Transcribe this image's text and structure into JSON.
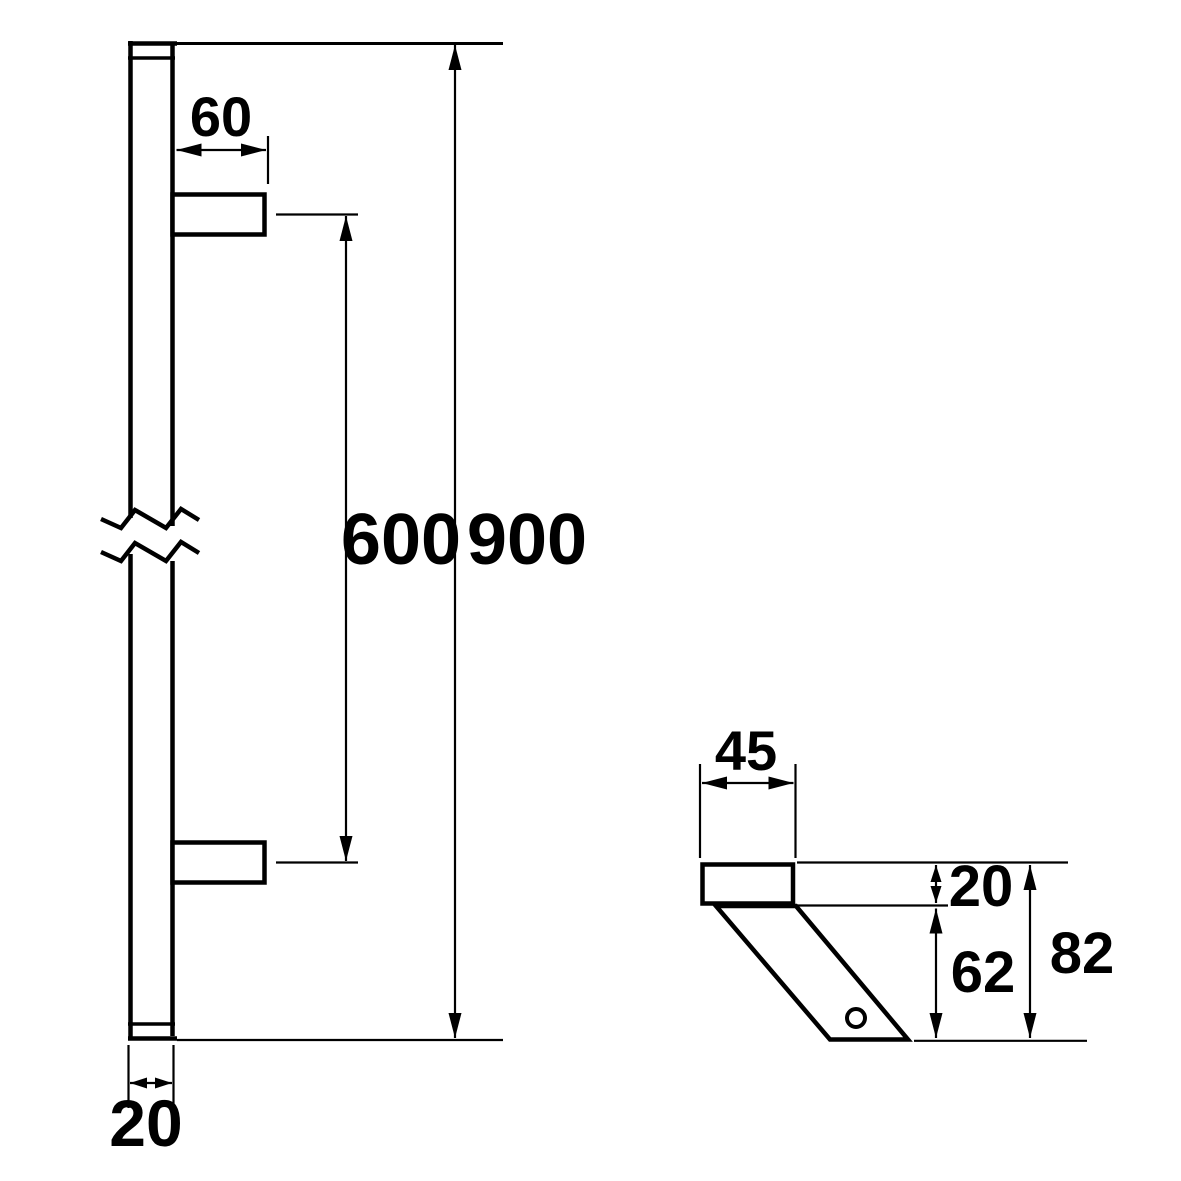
{
  "colors": {
    "line": "#000000",
    "background": "#ffffff"
  },
  "side_view": {
    "bracket_depth": "60",
    "bracket_spacing": "600",
    "overall_length": "900",
    "bar_width": "20"
  },
  "detail_view": {
    "bracket_width": "45",
    "plate_thickness": "20",
    "arm_drop": "62",
    "overall_projection": "82"
  }
}
